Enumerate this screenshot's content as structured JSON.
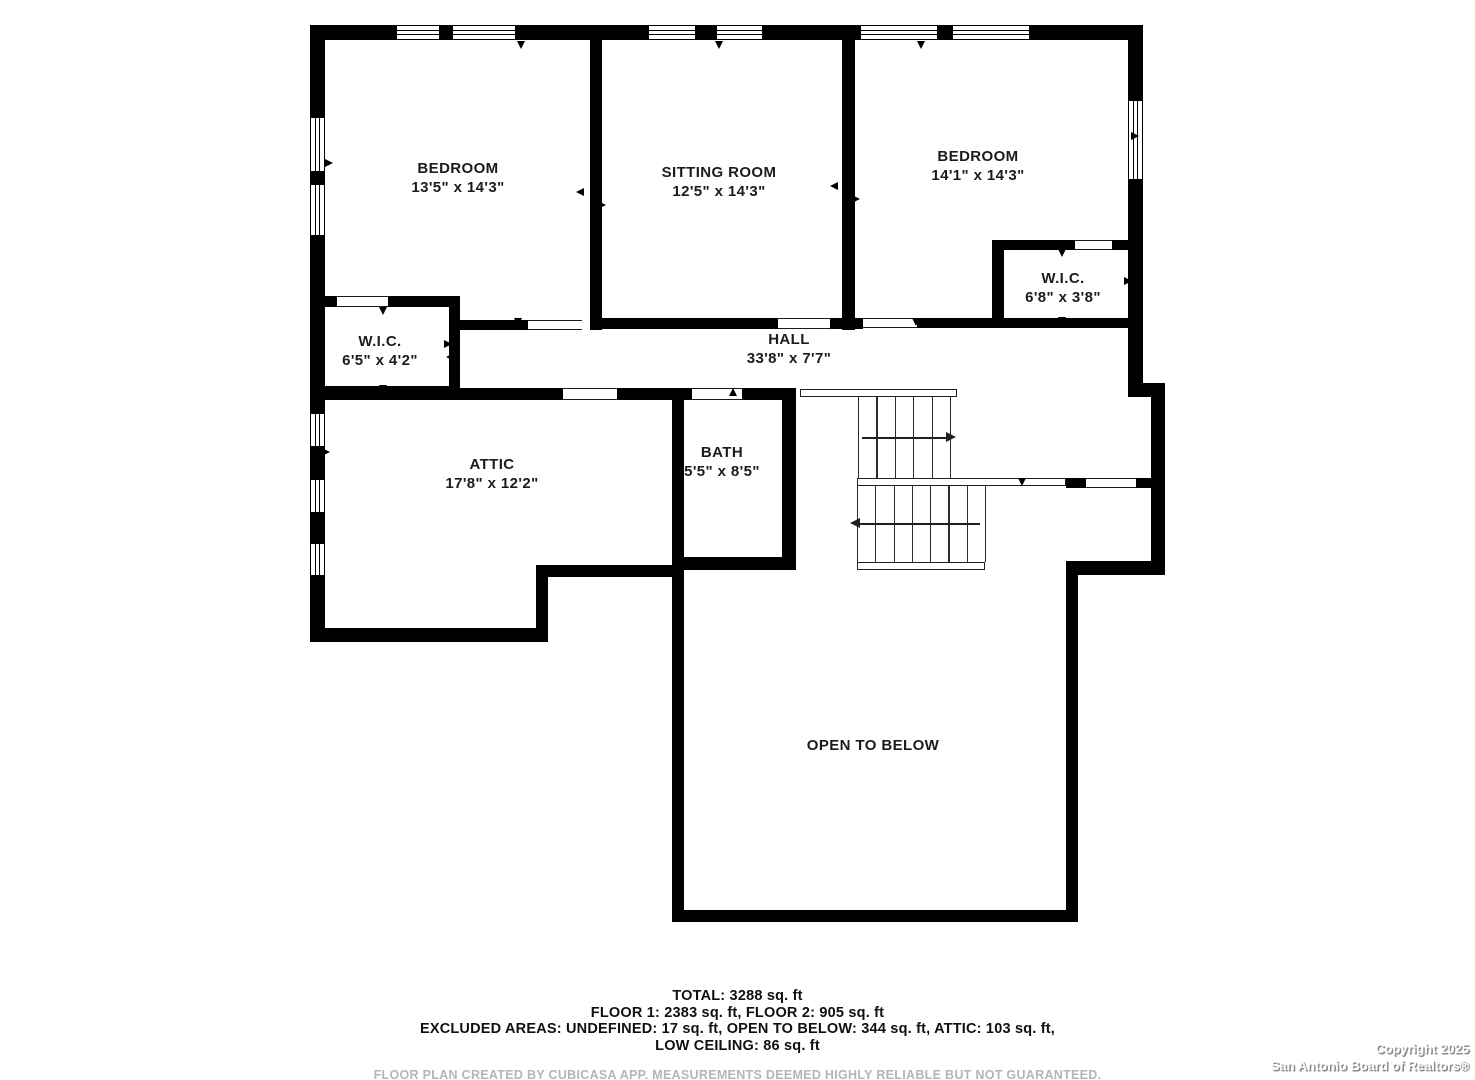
{
  "colors": {
    "wall": "#000000",
    "background": "#ffffff",
    "label": "#1c1c1c",
    "muted": "#b5b5b5"
  },
  "plan": {
    "rooms": [
      {
        "id": "bedroom-1",
        "name": "BEDROOM",
        "dims": "13'5\" x 14'3\"",
        "cx": 458,
        "cy": 160
      },
      {
        "id": "sitting-room",
        "name": "SITTING ROOM",
        "dims": "12'5\" x 14'3\"",
        "cx": 719,
        "cy": 164
      },
      {
        "id": "bedroom-2",
        "name": "BEDROOM",
        "dims": "14'1\" x 14'3\"",
        "cx": 978,
        "cy": 148
      },
      {
        "id": "wic-right",
        "name": "W.I.C.",
        "dims": "6'8\" x 3'8\"",
        "cx": 1063,
        "cy": 270
      },
      {
        "id": "wic-left",
        "name": "W.I.C.",
        "dims": "6'5\" x 4'2\"",
        "cx": 380,
        "cy": 333
      },
      {
        "id": "hall",
        "name": "HALL",
        "dims": "33'8\" x 7'7\"",
        "cx": 789,
        "cy": 331
      },
      {
        "id": "attic",
        "name": "ATTIC",
        "dims": "17'8\" x 12'2\"",
        "cx": 492,
        "cy": 456
      },
      {
        "id": "bath",
        "name": "BATH",
        "dims": "5'5\" x 8'5\"",
        "cx": 722,
        "cy": 444
      },
      {
        "id": "open-to-below",
        "name": "OPEN TO BELOW",
        "dims": "",
        "cx": 873,
        "cy": 737
      }
    ],
    "walls": [
      [
        315,
        25,
        828,
        15
      ],
      [
        310,
        25,
        15,
        617
      ],
      [
        1128,
        25,
        15,
        365
      ],
      [
        1128,
        383,
        37,
        14
      ],
      [
        1151,
        383,
        14,
        192
      ],
      [
        1066,
        561,
        99,
        14
      ],
      [
        1066,
        561,
        12,
        361
      ],
      [
        672,
        910,
        406,
        12
      ],
      [
        672,
        565,
        12,
        357
      ],
      [
        310,
        628,
        238,
        14
      ],
      [
        536,
        565,
        12,
        77
      ],
      [
        536,
        565,
        148,
        12
      ],
      [
        590,
        40,
        12,
        290
      ],
      [
        842,
        40,
        13,
        290
      ],
      [
        595,
        318,
        183,
        11
      ],
      [
        830,
        318,
        33,
        11
      ],
      [
        917,
        318,
        215,
        10
      ],
      [
        992,
        240,
        12,
        88
      ],
      [
        992,
        240,
        83,
        10
      ],
      [
        1112,
        240,
        20,
        10
      ],
      [
        323,
        296,
        14,
        11
      ],
      [
        388,
        296,
        65,
        11
      ],
      [
        449,
        296,
        11,
        101
      ],
      [
        323,
        386,
        136,
        11
      ],
      [
        460,
        320,
        68,
        10
      ],
      [
        325,
        388,
        238,
        12
      ],
      [
        617,
        388,
        75,
        12
      ],
      [
        742,
        388,
        54,
        12
      ],
      [
        672,
        388,
        12,
        180
      ],
      [
        782,
        388,
        14,
        182
      ],
      [
        672,
        557,
        124,
        13
      ],
      [
        1066,
        478,
        20,
        10
      ],
      [
        1136,
        478,
        15,
        10
      ]
    ],
    "windows": [
      {
        "r": [
          396,
          25,
          44,
          15
        ],
        "o": "h"
      },
      {
        "r": [
          452,
          25,
          64,
          15
        ],
        "o": "h"
      },
      {
        "r": [
          648,
          25,
          48,
          15
        ],
        "o": "h"
      },
      {
        "r": [
          716,
          25,
          47,
          15
        ],
        "o": "h"
      },
      {
        "r": [
          860,
          25,
          78,
          15
        ],
        "o": "h"
      },
      {
        "r": [
          952,
          25,
          78,
          15
        ],
        "o": "h"
      },
      {
        "r": [
          310,
          117,
          15,
          55
        ],
        "o": "v"
      },
      {
        "r": [
          310,
          184,
          15,
          52
        ],
        "o": "v"
      },
      {
        "r": [
          310,
          413,
          15,
          34
        ],
        "o": "v"
      },
      {
        "r": [
          310,
          479,
          15,
          34
        ],
        "o": "v"
      },
      {
        "r": [
          310,
          543,
          15,
          33
        ],
        "o": "v"
      },
      {
        "r": [
          1128,
          100,
          15,
          80
        ],
        "o": "v"
      }
    ],
    "door_gaps": [
      [
        337,
        296,
        51,
        11
      ],
      [
        528,
        320,
        54,
        10
      ],
      [
        778,
        318,
        52,
        11
      ],
      [
        863,
        318,
        54,
        10
      ],
      [
        1075,
        240,
        37,
        10
      ],
      [
        563,
        388,
        54,
        12
      ],
      [
        692,
        388,
        50,
        12
      ],
      [
        1086,
        478,
        50,
        10
      ]
    ],
    "markers": [
      [
        521,
        41,
        "d"
      ],
      [
        719,
        41,
        "d"
      ],
      [
        921,
        41,
        "d"
      ],
      [
        325,
        163,
        "r"
      ],
      [
        322,
        452,
        "r"
      ],
      [
        584,
        192,
        "l"
      ],
      [
        598,
        205,
        "r"
      ],
      [
        838,
        186,
        "l"
      ],
      [
        852,
        199,
        "r"
      ],
      [
        1131,
        136,
        "r"
      ],
      [
        1131,
        355,
        "r"
      ],
      [
        718,
        318,
        "d"
      ],
      [
        916,
        318,
        "d"
      ],
      [
        518,
        318,
        "d"
      ],
      [
        1062,
        249,
        "d"
      ],
      [
        1062,
        317,
        "d"
      ],
      [
        995,
        281,
        "r"
      ],
      [
        1124,
        281,
        "r"
      ],
      [
        383,
        307,
        "d"
      ],
      [
        383,
        385,
        "d"
      ],
      [
        318,
        346,
        "l"
      ],
      [
        444,
        344,
        "r"
      ],
      [
        454,
        357,
        "l"
      ],
      [
        470,
        396,
        "u"
      ],
      [
        733,
        396,
        "u"
      ],
      [
        475,
        630,
        "d"
      ],
      [
        733,
        558,
        "d"
      ],
      [
        1022,
        478,
        "d"
      ]
    ],
    "stairs": {
      "bars": [
        [
          800,
          389,
          157,
          8
        ],
        [
          857,
          478,
          209,
          8
        ],
        [
          857,
          562,
          128,
          8
        ]
      ],
      "flights": [
        {
          "x": 858,
          "y": 397,
          "w": 92,
          "h": 81,
          "lines": 6
        },
        {
          "x": 857,
          "y": 486,
          "w": 128,
          "h": 76,
          "lines": 8
        }
      ],
      "arrows": [
        {
          "x1": 862,
          "x2": 946,
          "y": 437,
          "head": "right"
        },
        {
          "x1": 860,
          "x2": 980,
          "y": 523,
          "head": "left"
        }
      ]
    }
  },
  "footer": {
    "line1": "TOTAL: 3288 sq. ft",
    "line2": "FLOOR 1: 2383 sq. ft, FLOOR 2: 905 sq. ft",
    "line3": "EXCLUDED AREAS: UNDEFINED: 17 sq. ft, OPEN TO BELOW: 344 sq. ft, ATTIC: 103 sq. ft,",
    "line4": "LOW CEILING: 86 sq. ft",
    "disclaimer": "FLOOR PLAN CREATED BY CUBICASA APP. MEASUREMENTS DEEMED HIGHLY RELIABLE BUT NOT GUARANTEED."
  },
  "copyright": {
    "line1": "Copyright 2025",
    "line2": "San Antonio Board of Realtors®"
  }
}
